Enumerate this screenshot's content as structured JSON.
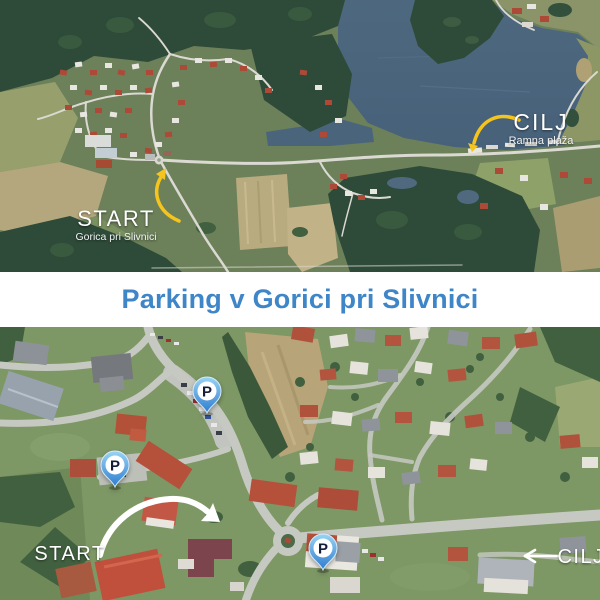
{
  "title": {
    "text": "Parking v Gorici pri Slivnici"
  },
  "top_map": {
    "start": {
      "label": "START",
      "sublabel": "Gorica pri Slivnici"
    },
    "cilj": {
      "label": "CILJ",
      "sublabel": "Ramna plaža"
    }
  },
  "bottom_map": {
    "start": {
      "label": "START"
    },
    "cilj": {
      "label": "CILJ"
    },
    "pins": [
      {
        "label": "P"
      },
      {
        "label": "P"
      },
      {
        "label": "P"
      }
    ]
  },
  "colors": {
    "title_blue": "#3e86c8",
    "route_yellow": "#f5c41d",
    "label_white": "#ffffff",
    "pin_gradient_top": "#9ad4f4",
    "pin_gradient_bottom": "#2e7ccf",
    "pin_letter": "#141e36"
  }
}
